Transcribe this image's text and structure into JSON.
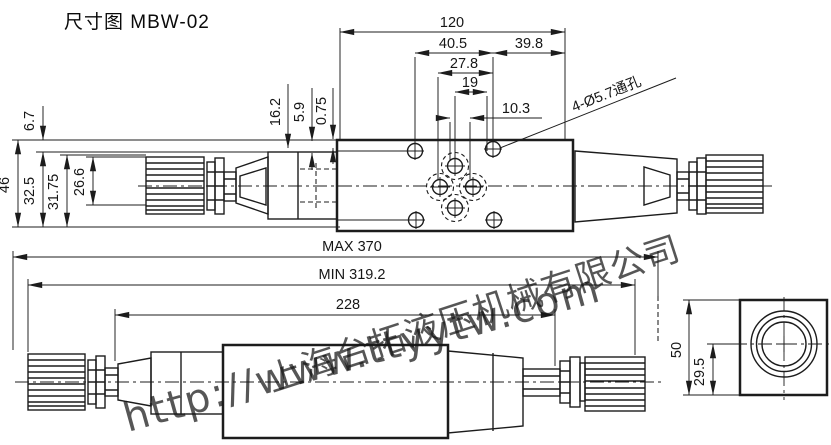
{
  "title": "尺寸图 MBW-02",
  "top_view": {
    "dim_120": "120",
    "dim_40_5": "40.5",
    "dim_39_8": "39.8",
    "dim_27_8": "27.8",
    "dim_19": "19",
    "dim_10_3": "10.3",
    "dim_16_2": "16.2",
    "dim_5_9": "5.9",
    "dim_0_75": "0.75",
    "dim_6_7": "6.7",
    "dim_46": "46",
    "dim_32_5": "32.5",
    "dim_31_75": "31.75",
    "dim_26_6": "26.6",
    "hole_note": "4-Ø5.7通孔"
  },
  "side_view": {
    "dim_max": "MAX 370",
    "dim_min": "MIN 319.2",
    "dim_228": "228"
  },
  "end_view": {
    "dim_50": "50",
    "dim_29_5": "29.5"
  },
  "watermark": {
    "company": "上海台拓液压机械有限公司",
    "website": "http://www.ttyytw.com",
    "color": "#8e9cec"
  },
  "colors": {
    "line": "#1c1c1c",
    "background": "#ffffff"
  }
}
